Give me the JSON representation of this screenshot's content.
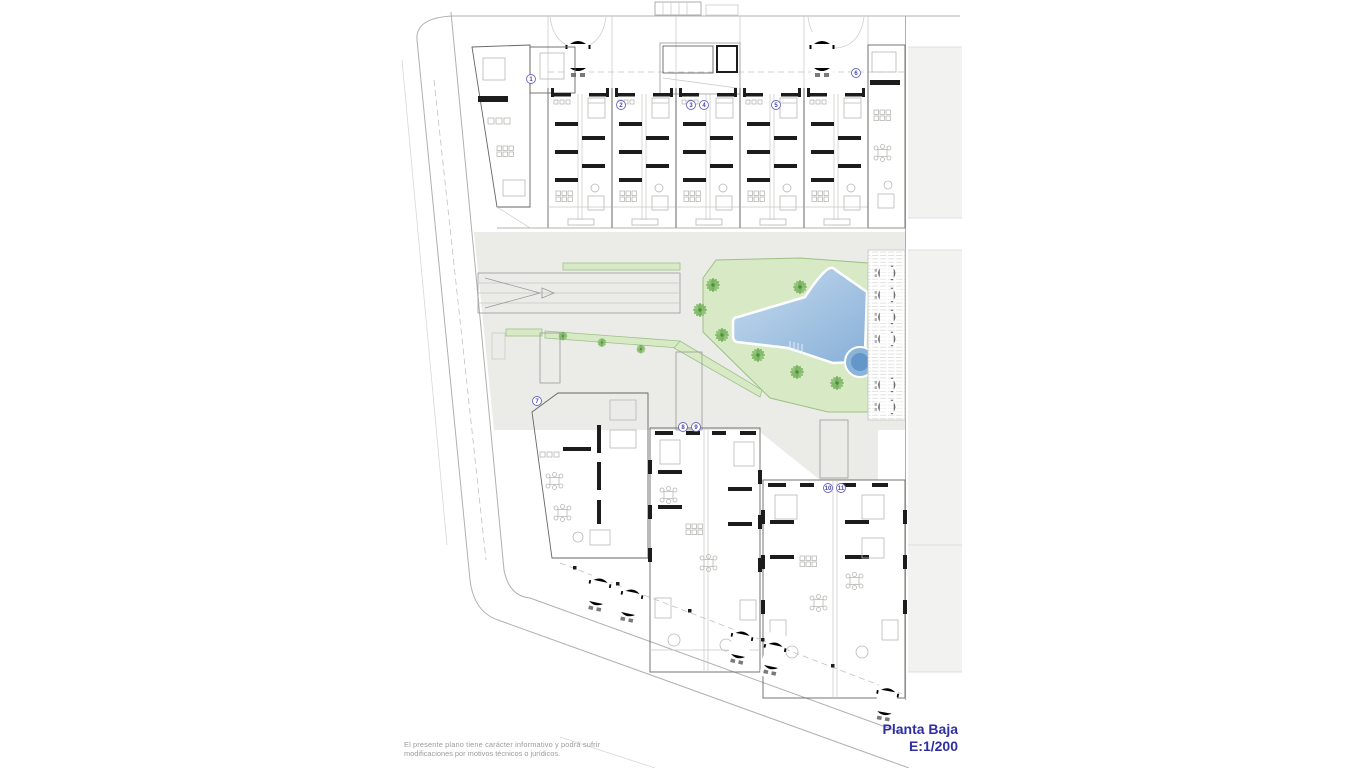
{
  "page": {
    "width": 1366,
    "height": 768,
    "background": "#ffffff"
  },
  "title_block": {
    "title": "Planta Baja",
    "scale": "E:1/200",
    "color": "#2f2fa2"
  },
  "disclaimer": {
    "line1": "El presente plano tiene carácter informativo y podrá sufrir",
    "line2": "modificaciones por motivos técnicos o jurídicos.",
    "color": "#9c9c9c"
  },
  "plan": {
    "unit_numbers": [
      "1",
      "2",
      "3",
      "4",
      "5",
      "6",
      "7",
      "8",
      "9",
      "10",
      "11"
    ]
  },
  "colors": {
    "courtyard_gray": "#ebebe8",
    "garden_green": "#d8e9c5",
    "garden_border": "#9cc285",
    "palm_green": "#7db763",
    "palm_dark": "#4e8f3c",
    "pool_light": "#c6dbef",
    "pool_dark": "#88b0d8",
    "pool_border": "#ffffff",
    "spa_outer": "#8ab4da",
    "spa_inner": "#5d92c4",
    "wall_black": "#1c1c1c",
    "block_gray": "#f2f2f0",
    "street_gray": "#b0b0ae",
    "number_blue": "#4646ae",
    "car_gray": "#a9a9a7"
  }
}
